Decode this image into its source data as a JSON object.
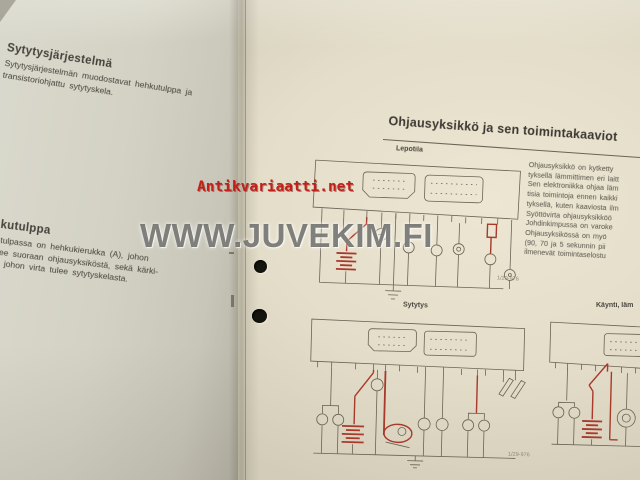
{
  "photo": {
    "description": "Photograph of an open Finnish service-manual spread with ignition-system text and control-unit wiring diagrams",
    "colors": {
      "left_page": "#d3d2c4",
      "right_page": "#e7e1cd",
      "diagram_line": "#6b6356",
      "circuit_red": "#a8392b",
      "watermark_red": "#c3201a",
      "watermark_gray": "#64645f",
      "punch_hole": "#15150f"
    }
  },
  "left_page": {
    "section1": {
      "heading": "Sytytysjärjestelmä",
      "lines": [
        "Sytytysjärjestelmän muodostavat hehkutulppa ja",
        "transistoriohjattu sytytyskela."
      ]
    },
    "section2": {
      "heading": "hkutulppa",
      "lines": [
        "kutulpassa on hehkukierukka (A), johon",
        "tulee suoraan ohjausyksiköstä, sekä kärki-",
        "B), johon virta tulee sytytyskelasta."
      ]
    }
  },
  "right_page": {
    "title": "Ohjausyksikkö ja sen toimintakaaviot",
    "diagram1_label": "Lepotila",
    "diagram2_label": "Sytytys",
    "diagram3_label": "Käynti, läm",
    "caption1": "1/29-976",
    "caption2": "1/29-976",
    "column_lines": [
      "Ohjausyksikkö on kytketty",
      "tyksellä lämmittimen eri laitt",
      "Sen elektroniikka ohjaa läm",
      "tisia toimintoja ennen kaikki",
      "tyksellä, kuten kaaviosta ilm",
      "Syöttövirta ohjausyksikköö",
      "Johdinkimpussa on varoke",
      "Ohjausyksikössä on myö",
      "(90, 70 ja 5 sekunnin pii",
      "ilmenevät toimintaselostu"
    ]
  },
  "watermarks": {
    "red_text": "Antikvariaatti.net",
    "gray_text": "WWW.JUVEKIM.FI"
  }
}
